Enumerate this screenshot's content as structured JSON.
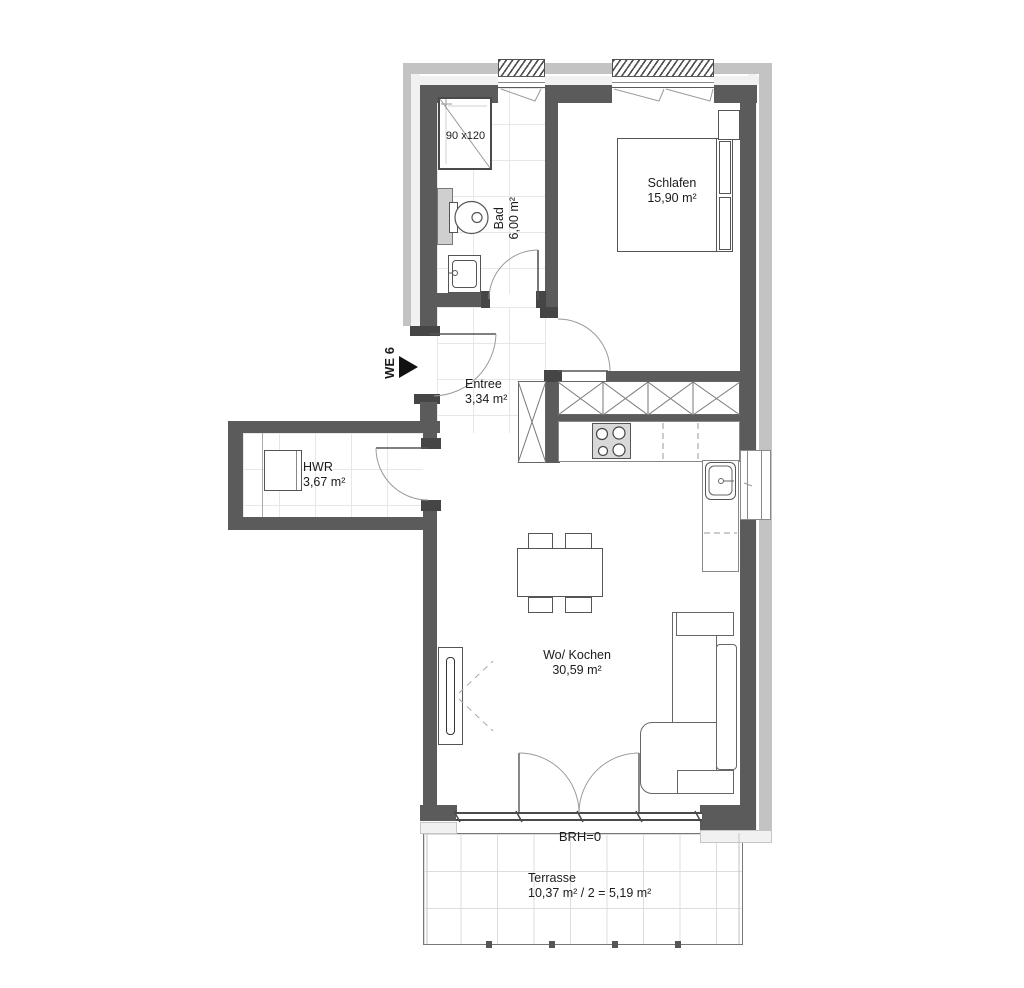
{
  "plan": {
    "title": "Apartment floor plan",
    "unit_label": "WE 6",
    "rooms": [
      {
        "id": "schlafen",
        "name": "Schlafen",
        "area": "15,90 m²"
      },
      {
        "id": "bad",
        "name": "Bad",
        "area": "6,00 m²"
      },
      {
        "id": "entree",
        "name": "Entree",
        "area": "3,34 m²"
      },
      {
        "id": "hwr",
        "name": "HWR",
        "area": "3,67 m²"
      },
      {
        "id": "wo-kochen",
        "name": "Wo/ Kochen",
        "area": "30,59 m²"
      },
      {
        "id": "terrasse",
        "name": "Terrasse",
        "area": "10,37 m² / 2 = 5,19 m²"
      }
    ],
    "annotations": {
      "shower_size": "90 x120",
      "brh": "BRH=0"
    },
    "colors": {
      "wall": "#5b5b5b",
      "jamb": "#454545",
      "facOuter": "#c3c3c3",
      "facInner": "#f1f1f1",
      "tile": "#e7e7e7",
      "lineDark": "#4a4a4a",
      "lineMid": "#777777",
      "arc": "#9a9a9a",
      "txt": "#1b1b1b"
    }
  }
}
